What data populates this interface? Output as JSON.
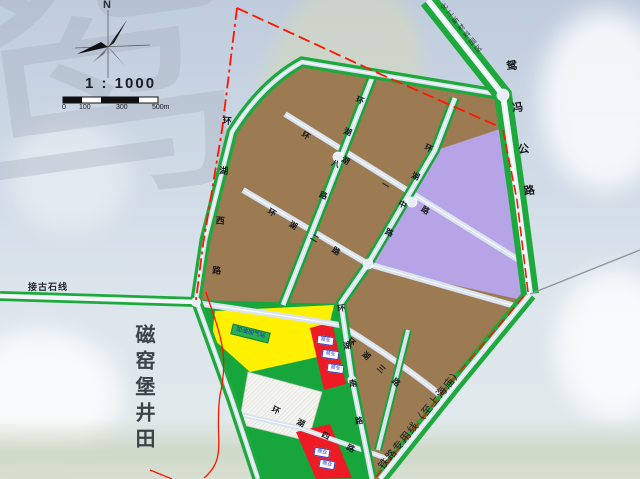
{
  "watermark": {
    "glyph": "鸳"
  },
  "compass": {
    "north_label": "N"
  },
  "scale": {
    "ratio_text": "1 : 1000",
    "ticks": [
      "0",
      "100",
      "300",
      "500m"
    ]
  },
  "area_labels": {
    "minefield": "磁窑堡井田",
    "railway_spur": "铁路专用线（至上海庙）",
    "chem_park": "化工新材料园区"
  },
  "roads": {
    "jiegushi": "接古石线",
    "highway": "鸳冯公路",
    "west": "环湖西路",
    "row1": "环湖一路",
    "row2": "环湖二路",
    "row3": "环湖三路",
    "row4": "环湖四路",
    "col8": "环湖八路",
    "colmid": "环湖中路",
    "colsouth": "环湖南路"
  },
  "parcel_labels": {
    "yellow_box": "加油加气站",
    "red_strip_boxes": [
      "商业",
      "商业",
      "商业"
    ],
    "red_block_boxes": [
      "商业",
      "商业"
    ]
  },
  "palette": {
    "sky_top": "#bfccdd",
    "sky_bottom": "#e3eaec",
    "ground_haze": "#cbd6c1",
    "parcel_brown": "#9d7b52",
    "parcel_purple": "#b6a4e6",
    "parcel_yellow": "#fff100",
    "parcel_red": "#ed1c24",
    "road_fill": "#d9e3f2",
    "road_green": "#1ea93c",
    "boundary_red": "#ff1500",
    "hatch_white": "#f4f4f0"
  }
}
